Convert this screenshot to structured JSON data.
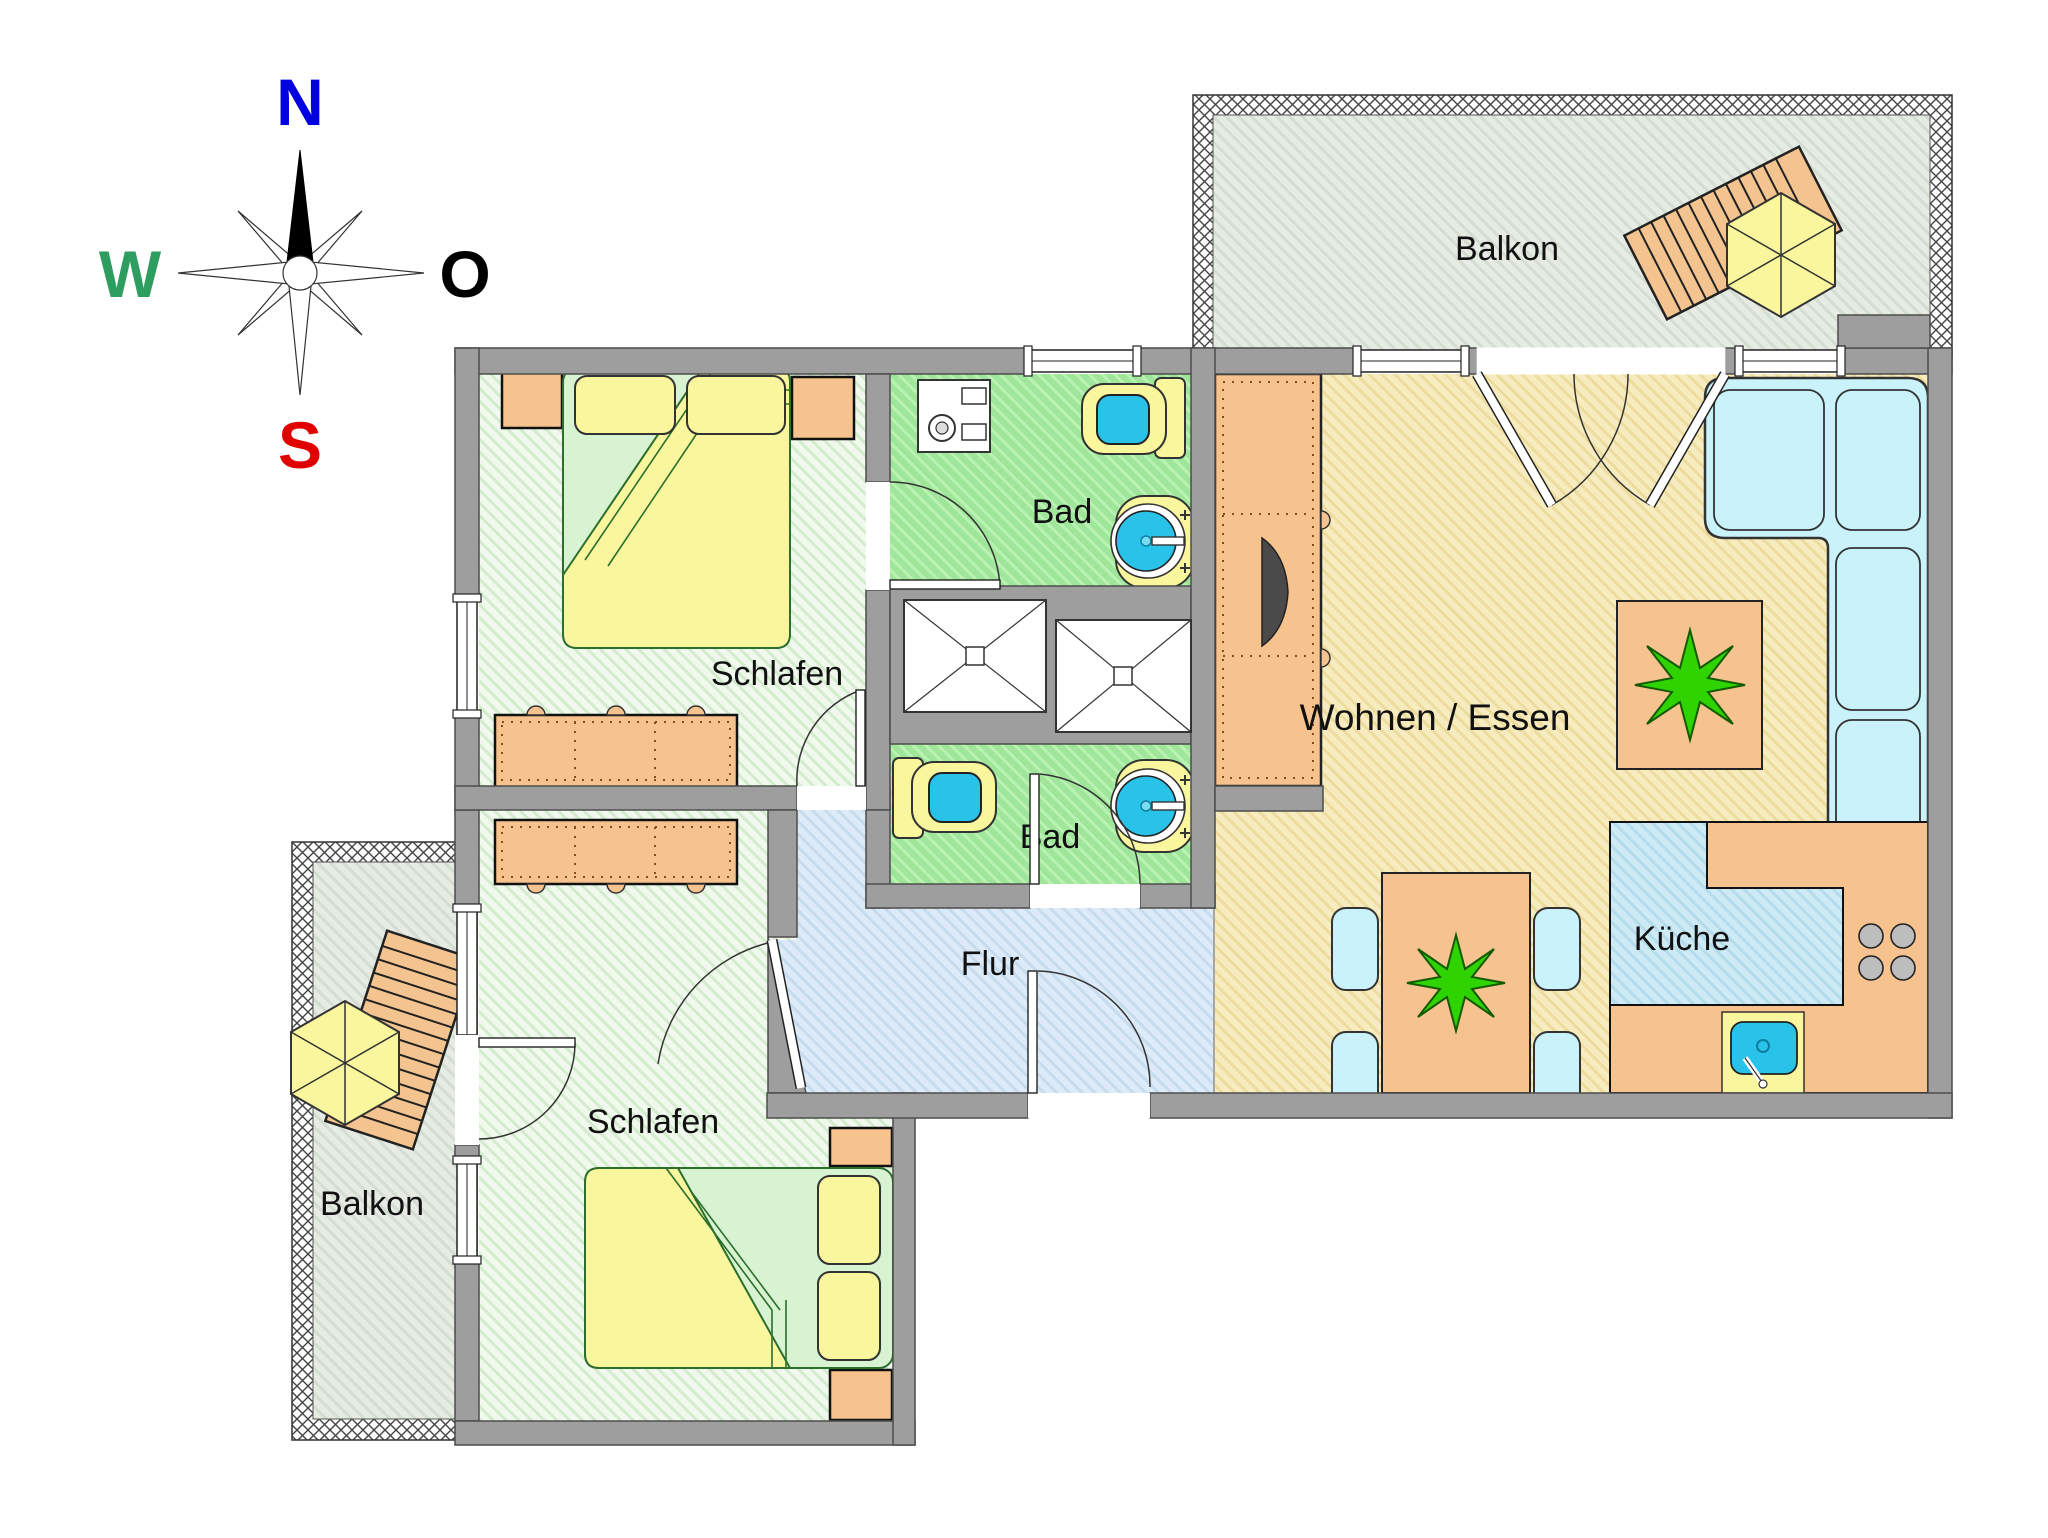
{
  "compass": {
    "n": "N",
    "e": "O",
    "s": "S",
    "w": "W"
  },
  "labels": {
    "balcony_top": "Balkon",
    "balcony_bottom": "Balkon",
    "bath_top": "Bad",
    "bath_bottom": "Bad",
    "bedroom_top": "Schlafen",
    "bedroom_bottom": "Schlafen",
    "hall": "Flur",
    "living": "Wohnen / Essen",
    "kitchen": "Küche"
  },
  "colors": {
    "wall": "#9e9e9e",
    "bedroom_floor": "#eef7ea",
    "bath_floor": "#9fe69a",
    "living_floor": "#f7ecc0",
    "hall_floor": "#dcebf7",
    "kitchen_floor": "#cdeaf5",
    "balcony_floor": "#e4eae2",
    "furniture_orange": "#f6c28e",
    "furniture_yellow": "#f9f69e",
    "water_cyan": "#29c3ea",
    "seat_cyan": "#c9f2fa",
    "plant_green": "#2fd400",
    "compass_north": "#0000e0",
    "compass_south": "#e00000",
    "compass_west": "#2e9e60",
    "compass_east": "#000000"
  }
}
